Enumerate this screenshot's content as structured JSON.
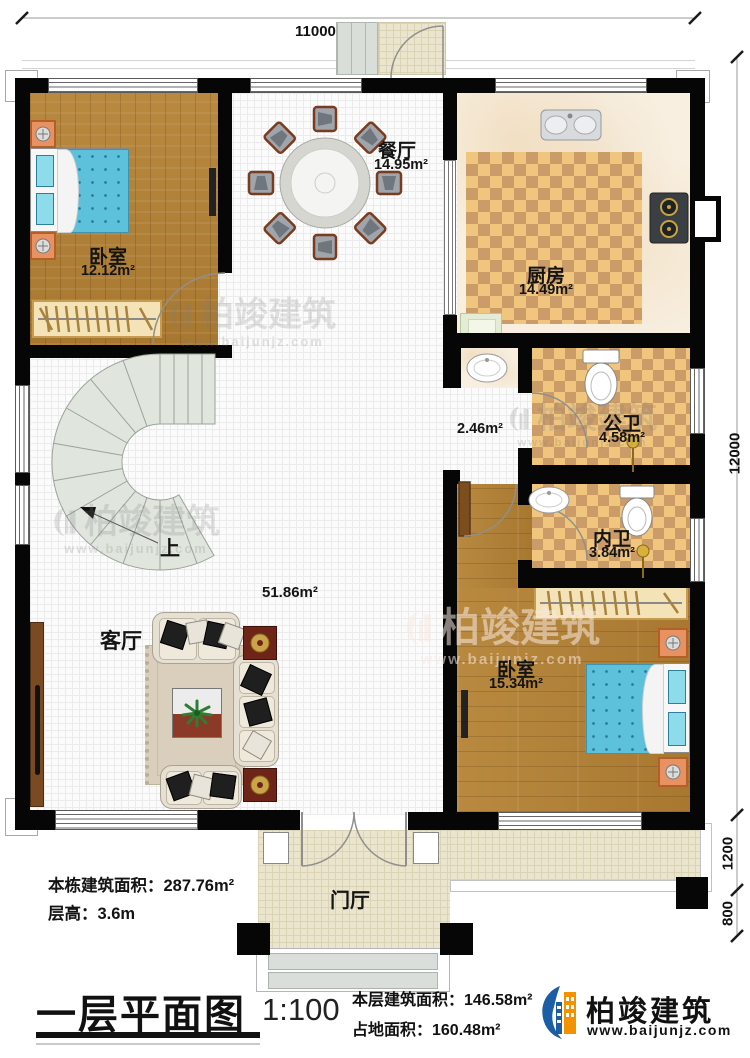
{
  "dimensions": {
    "width_top": "11000",
    "height_right": "12000",
    "porch_depth": "1200",
    "steps_depth": "800"
  },
  "rooms": {
    "bedroom_top": {
      "name": "卧室",
      "area": "12.12m²"
    },
    "dining": {
      "name": "餐厅",
      "area": "14.95m²"
    },
    "kitchen": {
      "name": "厨房",
      "area": "14.49m²"
    },
    "corridor": {
      "area": "2.46m²"
    },
    "bath_public": {
      "name": "公卫",
      "area": "4.58m²"
    },
    "bath_private": {
      "name": "内卫",
      "area": "3.84m²"
    },
    "bedroom_bottom": {
      "name": "卧室",
      "area": "15.34m²"
    },
    "living": {
      "name": "客厅",
      "area": "51.86m²"
    },
    "foyer": {
      "name": "门厅"
    },
    "stairs_up": "上"
  },
  "annotations": {
    "building_total_area": "本栋建筑面积：287.76m²",
    "floor_height": "层高：3.6m"
  },
  "footer": {
    "plan_title": "一层平面图",
    "scale": "1:100",
    "floor_area": "本层建筑面积：146.58m²",
    "ground_area": "占地面积：160.48m²"
  },
  "brand": {
    "name": "柏竣建筑",
    "website": "www.baijunjz.com"
  },
  "watermark": {
    "name": "柏竣建筑",
    "website": "www.baijunjz.com"
  },
  "colors": {
    "wall": "#060606",
    "wood_floor": "#b0813e",
    "checker_tile": "#f0c57e",
    "bed_blue": "#5ec1dc",
    "brand_blue": "#1b5ea6",
    "brand_orange": "#f39200"
  }
}
